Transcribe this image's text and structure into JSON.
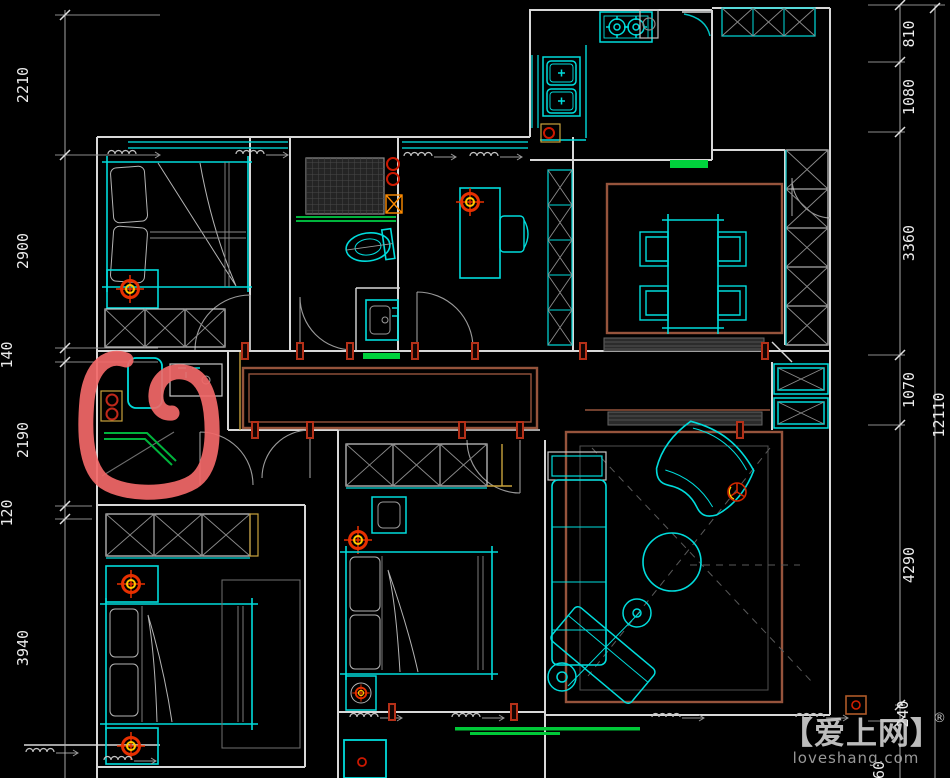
{
  "drawing": {
    "type": "apartment-floor-plan-cad",
    "background": "#000000",
    "colors": {
      "walls": "#d8d8d8",
      "furniture_cyan": "#00dcdc",
      "window_cyan": "#00c4c4",
      "rug_brown": "#96543c",
      "green_accent": "#00d23c",
      "khaki": "#c9a23c",
      "door_jamb_red": "#b53018",
      "ceiling_light_red": "#e83000",
      "ceiling_light_yellow": "#ffc800",
      "marker_red": "#f26868",
      "dimension_text": "#ececec"
    },
    "annotation": {
      "shape": "hand-drawn-loop-marker",
      "color": "#f26868",
      "area": "laundry-basin-corner"
    }
  },
  "dimensions": {
    "left": [
      "2210",
      "2900",
      "140",
      "2190",
      "120",
      "3940"
    ],
    "right_inner": [
      "810",
      "1080",
      "3360",
      "1070",
      "4290",
      "240"
    ],
    "right_outer": "12110",
    "bottom_right_partial": "60"
  },
  "watermark": {
    "brand": "【爱上网】",
    "registered": "®",
    "domain": "loveshang.com"
  }
}
